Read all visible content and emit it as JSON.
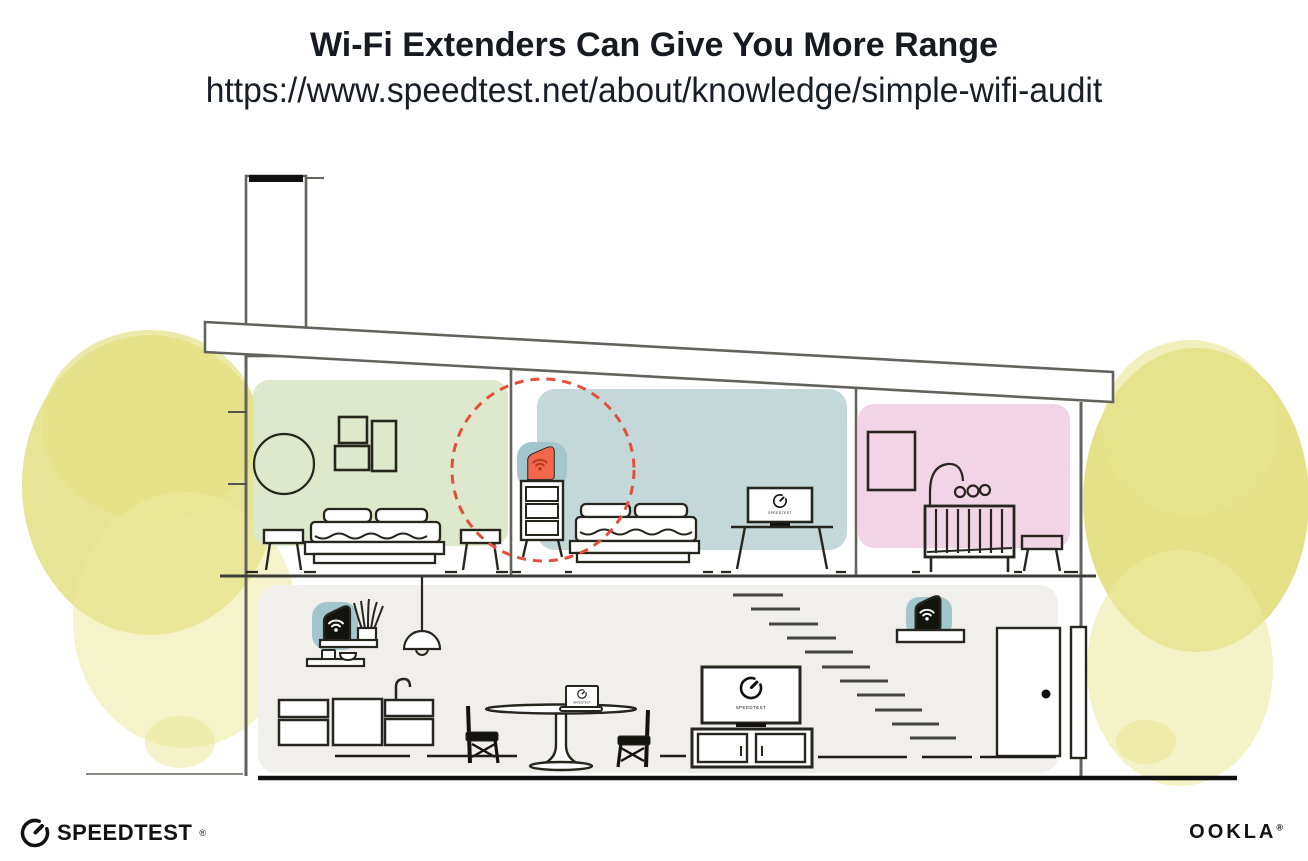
{
  "header": {
    "title": "Wi-Fi Extenders Can Give You More Range",
    "url": "https://www.speedtest.net/about/knowledge/simple-wifi-audit"
  },
  "device_screens": {
    "bedroom_tv_label": "SPEEDTEST",
    "living_room_tv_label": "SPEEDTEST",
    "laptop_label": "SPEEDTEST"
  },
  "footer": {
    "speedtest_wordmark": "SPEEDTEST",
    "speedtest_trademark": "®",
    "ookla_wordmark": "OOKLA",
    "ookla_trademark": "®"
  },
  "icons": {
    "speedtest_gauge": "gauge-icon",
    "wifi": "wifi-icon"
  },
  "colors": {
    "accent_orange": "#f26649",
    "range_circle_red": "#e2503b",
    "teal_highlight": "#a3c6cc",
    "bedroom_green": "#dde8cc",
    "bedroom_blue": "#c4d7d9",
    "nursery_pink": "#f1d4e5",
    "ground_floor_gray": "#f0efec",
    "foliage_yellow": "#e2df80",
    "ink": "#16191d"
  }
}
